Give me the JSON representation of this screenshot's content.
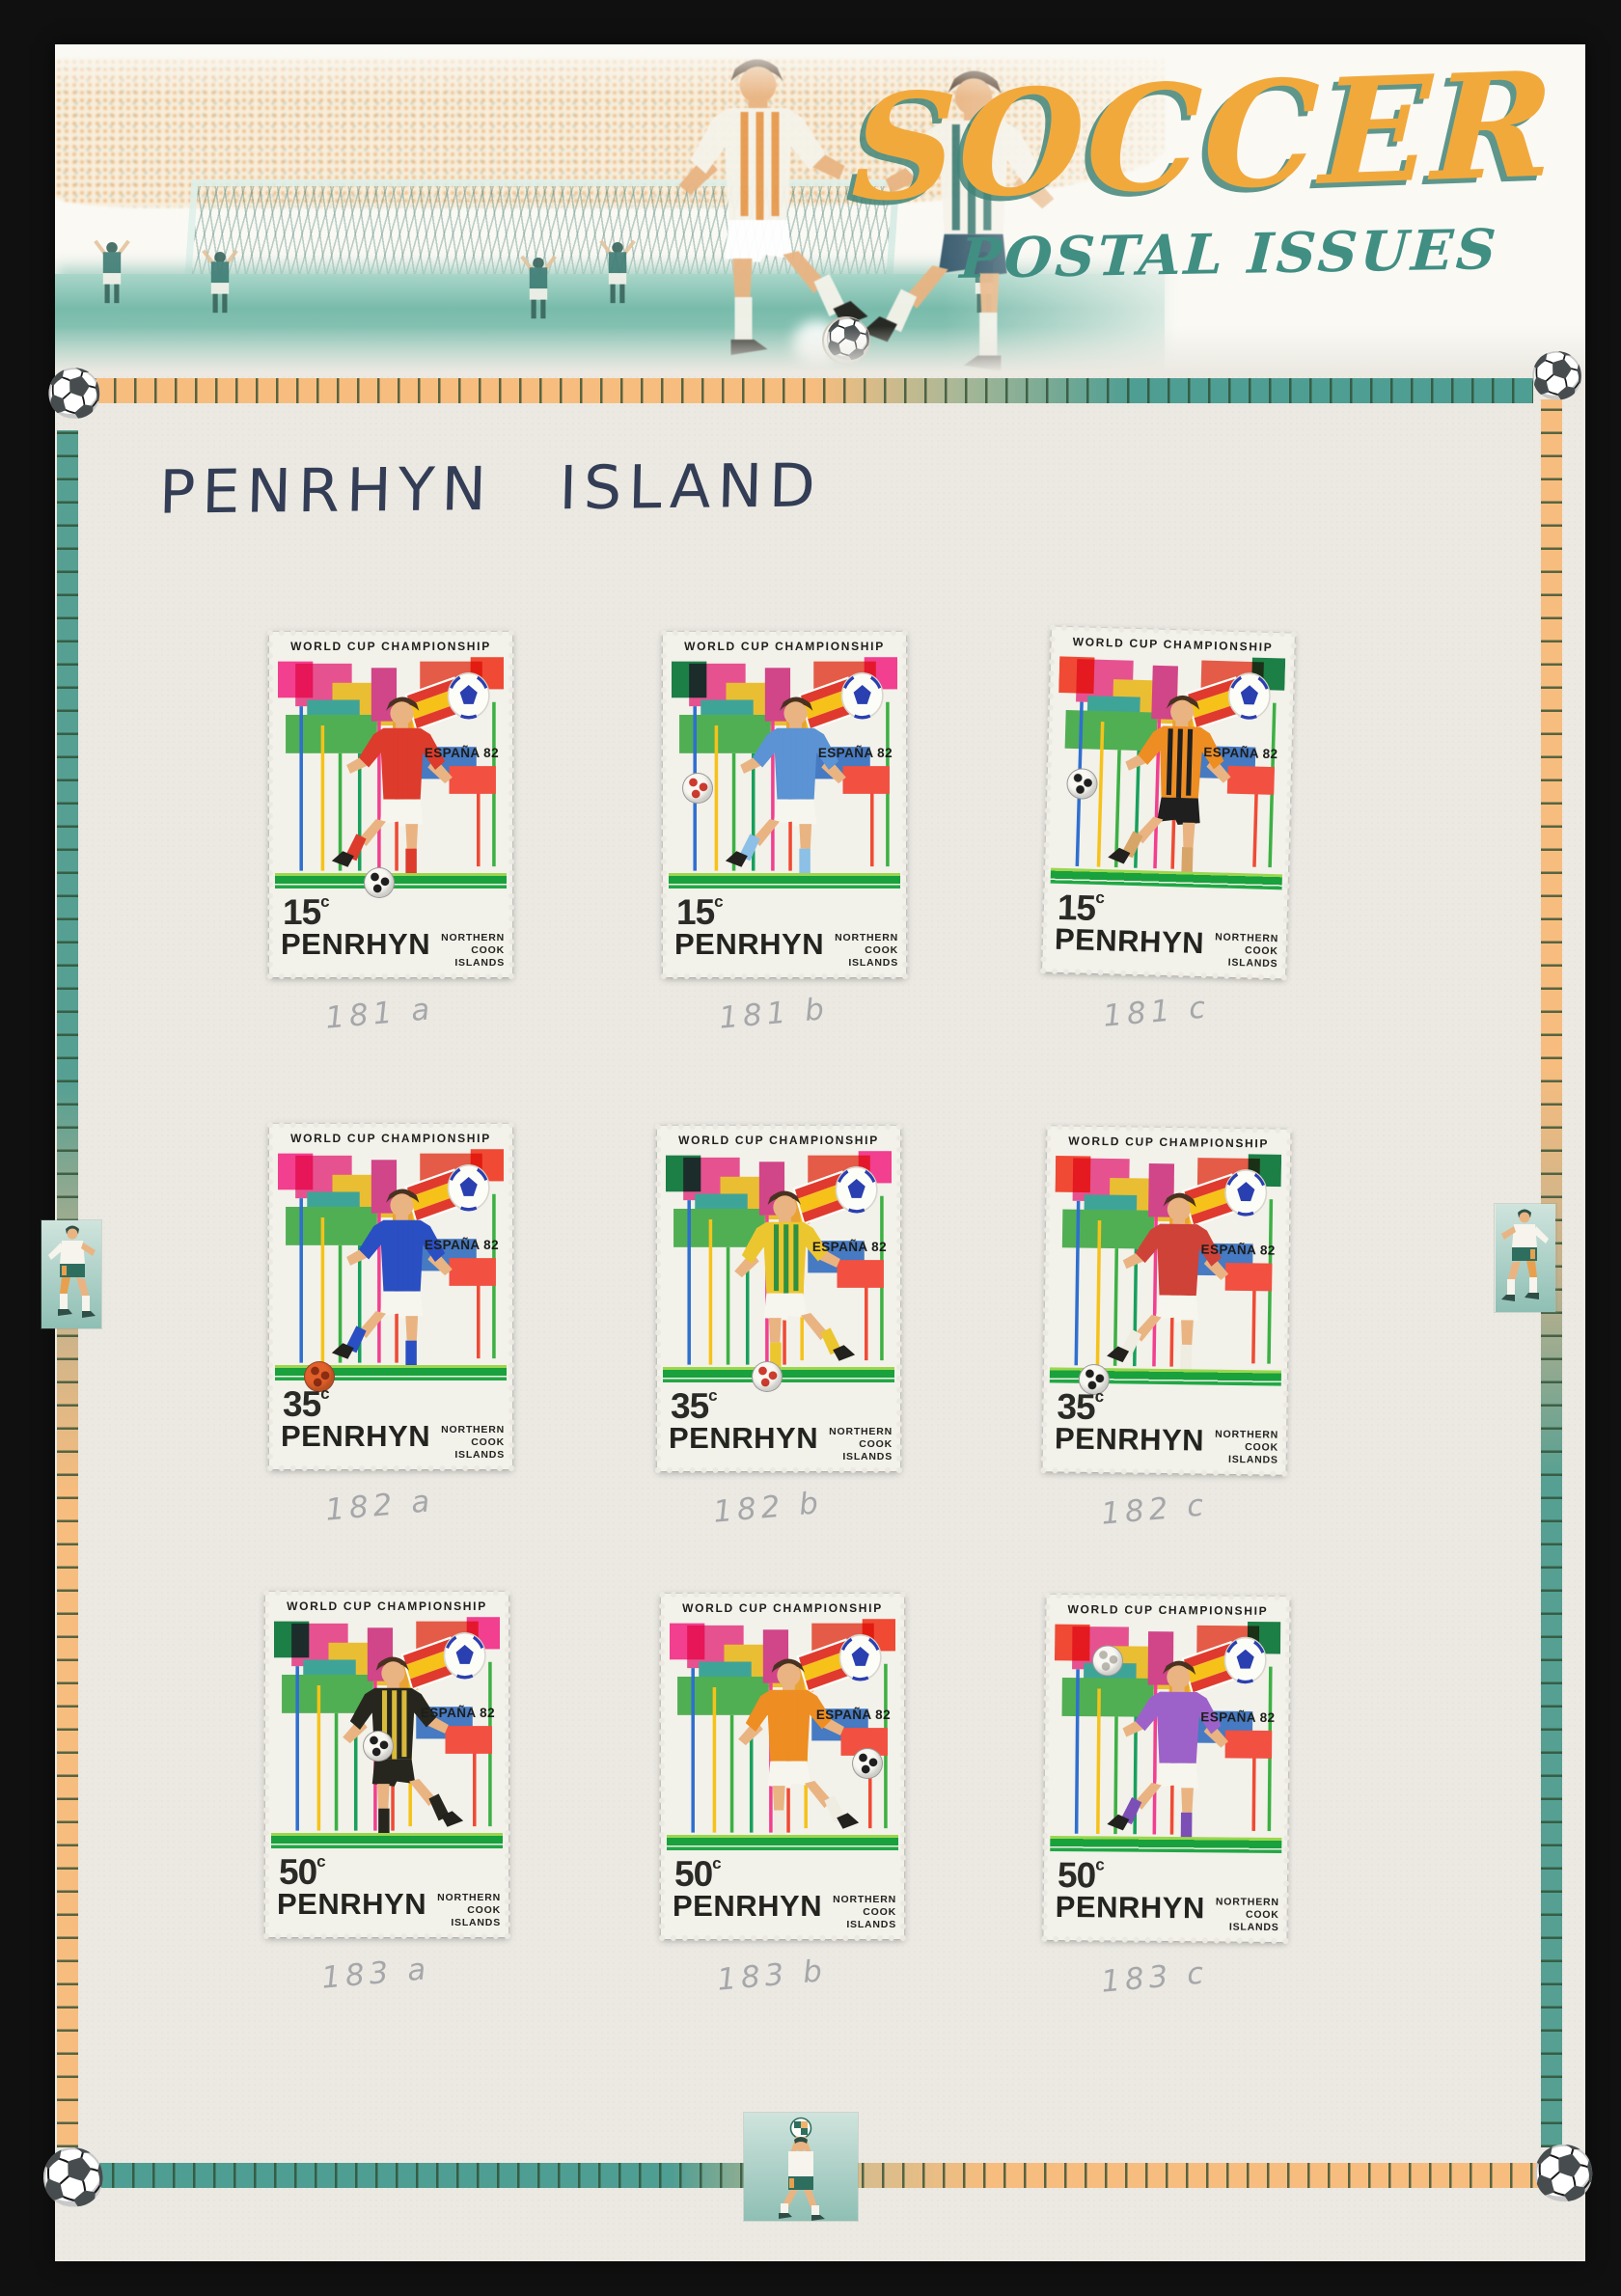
{
  "header": {
    "title": "SOCCER",
    "subtitle": "POSTAL ISSUES",
    "title_color": "#f2a93c",
    "title_shadow_color": "#42857a",
    "subtitle_color": "#418e83"
  },
  "handwritten_title": "PENRHYN ISLAND",
  "decor": {
    "teal": "#4f9e93",
    "orange": "#f7bd7e",
    "corner_icon": "soccer-ball-icon",
    "side_icons": "soccer-player-medallions"
  },
  "stamp_common": {
    "header_text": "WORLD CUP CHAMPIONSHIP",
    "emblem_text": "ESPAÑA 82",
    "country": "PENRHYN",
    "region_line1": "NORTHERN",
    "region_line2": "COOK ISLANDS",
    "currency_symbol": "c",
    "ground_green": "#18a13c"
  },
  "stamps": [
    {
      "value": "15",
      "annotation": "181 a",
      "kit": {
        "shirt": "#dd3b2c",
        "stripe": "",
        "shorts": "#f6f5ee",
        "socks": "#dd3b2c"
      },
      "art": {
        "ribbon_left": "#f23f8f",
        "ribbon_right": "#f04a34"
      },
      "ball": {
        "position": "low-center",
        "color": "#f8f7f2",
        "spot": "#1f1f1f"
      },
      "tilt": 0,
      "flip": true
    },
    {
      "value": "15",
      "annotation": "181 b",
      "kit": {
        "shirt": "#5b93d4",
        "stripe": "",
        "shorts": "#f6f5ee",
        "socks": "#8cc0e6"
      },
      "art": {
        "ribbon_left": "#1c7f46",
        "ribbon_right": "#f23f8f"
      },
      "ball": {
        "position": "mid-left",
        "color": "#f8f7f2",
        "spot": "#cc3b2e"
      },
      "tilt": 0,
      "flip": true
    },
    {
      "value": "15",
      "annotation": "181 c",
      "kit": {
        "shirt": "#ee8d22",
        "stripe": "#1f1f1f",
        "shorts": "#1f1f1f",
        "socks": "#d8a568"
      },
      "art": {
        "ribbon_left": "#f04a34",
        "ribbon_right": "#1c7f46"
      },
      "ball": {
        "position": "mid-left",
        "color": "#f8f7f2",
        "spot": "#1f1f1f"
      },
      "tilt": 1.6,
      "flip": true
    },
    {
      "value": "35",
      "annotation": "182 a",
      "kit": {
        "shirt": "#2a4fc2",
        "stripe": "",
        "shorts": "#f6f5ee",
        "socks": "#2a4fc2"
      },
      "art": {
        "ribbon_left": "#f23f8f",
        "ribbon_right": "#f04a34"
      },
      "ball": {
        "position": "low-left",
        "color": "#e2602a",
        "spot": "#8a2d12"
      },
      "tilt": 0,
      "flip": true
    },
    {
      "value": "35",
      "annotation": "182 b",
      "kit": {
        "shirt": "#ecc62f",
        "stripe": "#2f9140",
        "shorts": "#f6f5ee",
        "socks": "#ecc62f"
      },
      "art": {
        "ribbon_left": "#1c7f46",
        "ribbon_right": "#f23f8f"
      },
      "ball": {
        "position": "low-center",
        "color": "#f8f7f2",
        "spot": "#cc3b2e"
      },
      "tilt": 0,
      "flip": false
    },
    {
      "value": "35",
      "annotation": "182 c",
      "kit": {
        "shirt": "#cf4238",
        "stripe": "",
        "shorts": "#f6f5ee",
        "socks": "#efece2"
      },
      "art": {
        "ribbon_left": "#f04a34",
        "ribbon_right": "#1c7f46"
      },
      "ball": {
        "position": "low-left",
        "color": "#f8f7f2",
        "spot": "#1f1f1f"
      },
      "tilt": 0.8,
      "flip": true
    },
    {
      "value": "50",
      "annotation": "183 a",
      "kit": {
        "shirt": "#26261f",
        "stripe": "#d9b93a",
        "shorts": "#26261f",
        "socks": "#26261f"
      },
      "art": {
        "ribbon_left": "#1c7f46",
        "ribbon_right": "#f23f8f"
      },
      "ball": {
        "position": "held",
        "color": "#f8f7f2",
        "spot": "#1f1f1f"
      },
      "tilt": 0,
      "flip": false
    },
    {
      "value": "50",
      "annotation": "183 b",
      "kit": {
        "shirt": "#ee8d22",
        "stripe": "",
        "shorts": "#f6f5ee",
        "socks": "#efece2"
      },
      "art": {
        "ribbon_left": "#f23f8f",
        "ribbon_right": "#f04a34"
      },
      "ball": {
        "position": "mid-right",
        "color": "#f8f7f2",
        "spot": "#1f1f1f"
      },
      "tilt": 0,
      "flip": false
    },
    {
      "value": "50",
      "annotation": "183 c",
      "kit": {
        "shirt": "#9d62c9",
        "stripe": "",
        "shorts": "#f6f5ee",
        "socks": "#7b4fb5"
      },
      "art": {
        "ribbon_left": "#f04a34",
        "ribbon_right": "#1c7f46"
      },
      "ball": {
        "position": "up-left",
        "color": "#f8f7f2",
        "spot": "#b9b7ae"
      },
      "tilt": 0.5,
      "flip": true
    }
  ]
}
